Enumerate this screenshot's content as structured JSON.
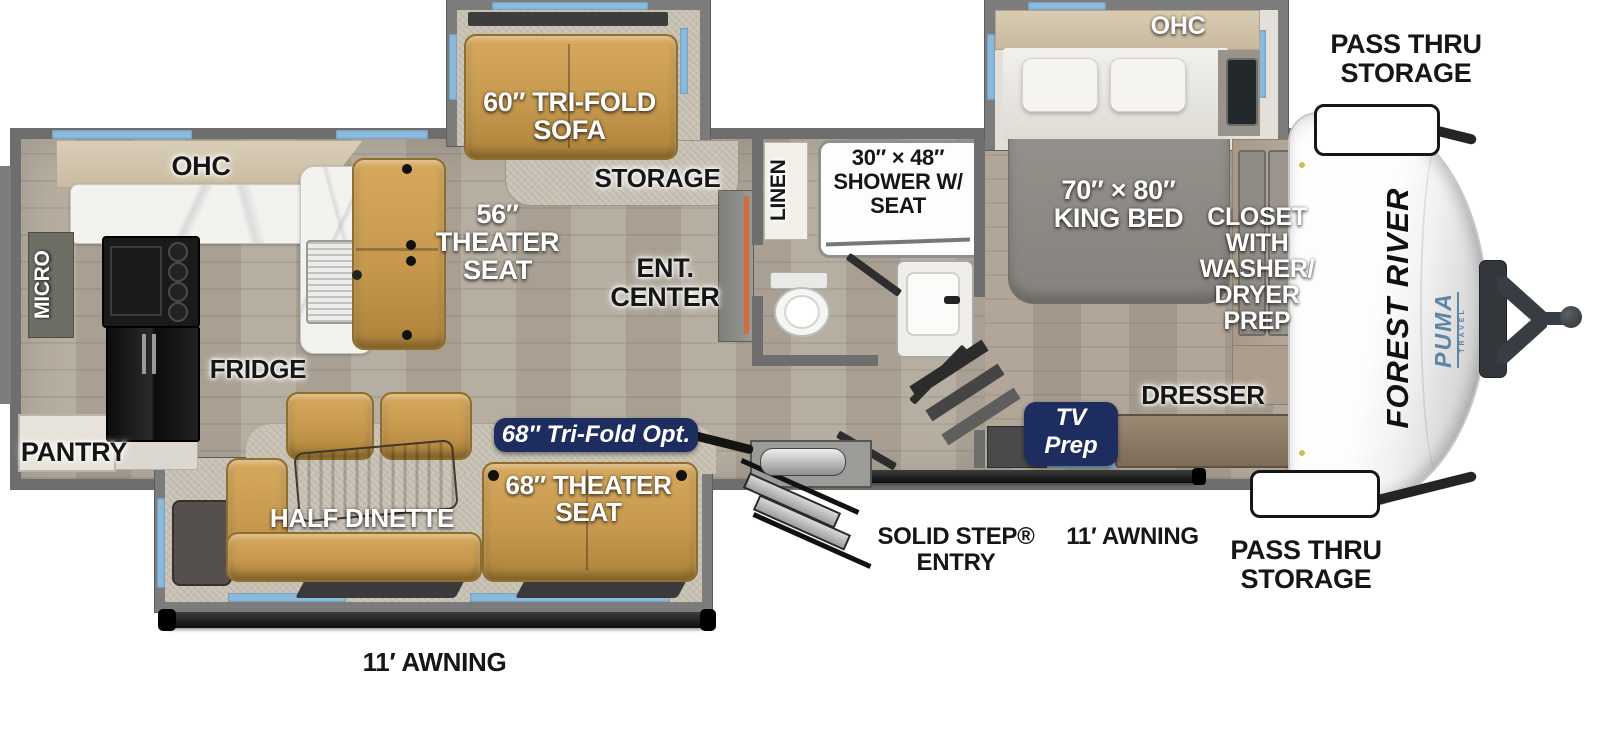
{
  "labels": {
    "kitchen_ohc": "OHC",
    "sofa60": [
      "60″ TRI-FOLD",
      "SOFA"
    ],
    "storage": "STORAGE",
    "linen": "LINEN",
    "shower": [
      "30″ × 48″",
      "SHOWER W/",
      "SEAT"
    ],
    "bed_ohc": "OHC",
    "pass_thru_top": [
      "PASS THRU",
      "STORAGE"
    ],
    "king_bed": [
      "70″ × 80″",
      "KING BED"
    ],
    "closet": [
      "CLOSET",
      "WITH",
      "WASHER/",
      "DRYER",
      "PREP"
    ],
    "theater56": [
      "56″",
      "THEATER",
      "SEAT"
    ],
    "ent_center": [
      "ENT.",
      "CENTER"
    ],
    "micro": "MICRO",
    "fridge": "FRIDGE",
    "pantry": "PANTRY",
    "half_dinette": "HALF DINETTE",
    "trifold_opt": "68″ Tri-Fold Opt.",
    "theater68": [
      "68″ THEATER",
      "SEAT"
    ],
    "tv_prep": [
      "TV",
      "Prep"
    ],
    "dresser": "DRESSER",
    "solid_step": [
      "SOLID STEP®",
      "ENTRY"
    ],
    "awning_door_side": "11′ AWNING",
    "pass_thru_bottom": [
      "PASS THRU",
      "STORAGE"
    ],
    "awning_camp_side": "11′ AWNING",
    "brand": {
      "manufacturer": "FOREST RIVER",
      "model": "PUMA",
      "model_sub": "TRAVEL"
    }
  },
  "colors": {
    "wall": "#6e6e6e",
    "slide_wall": "#7c7c7c",
    "window": "#8cbadd",
    "floor": "#b2a99b",
    "bedroom_floor": "#aca092",
    "carpet": "#c9c2b5",
    "marble": "#f3f2ef",
    "sofa": "#c6994f",
    "badge_navy": "#1d2d5f",
    "accent_orange": "#d86b3a",
    "brand_blue": "#5d85a8"
  }
}
